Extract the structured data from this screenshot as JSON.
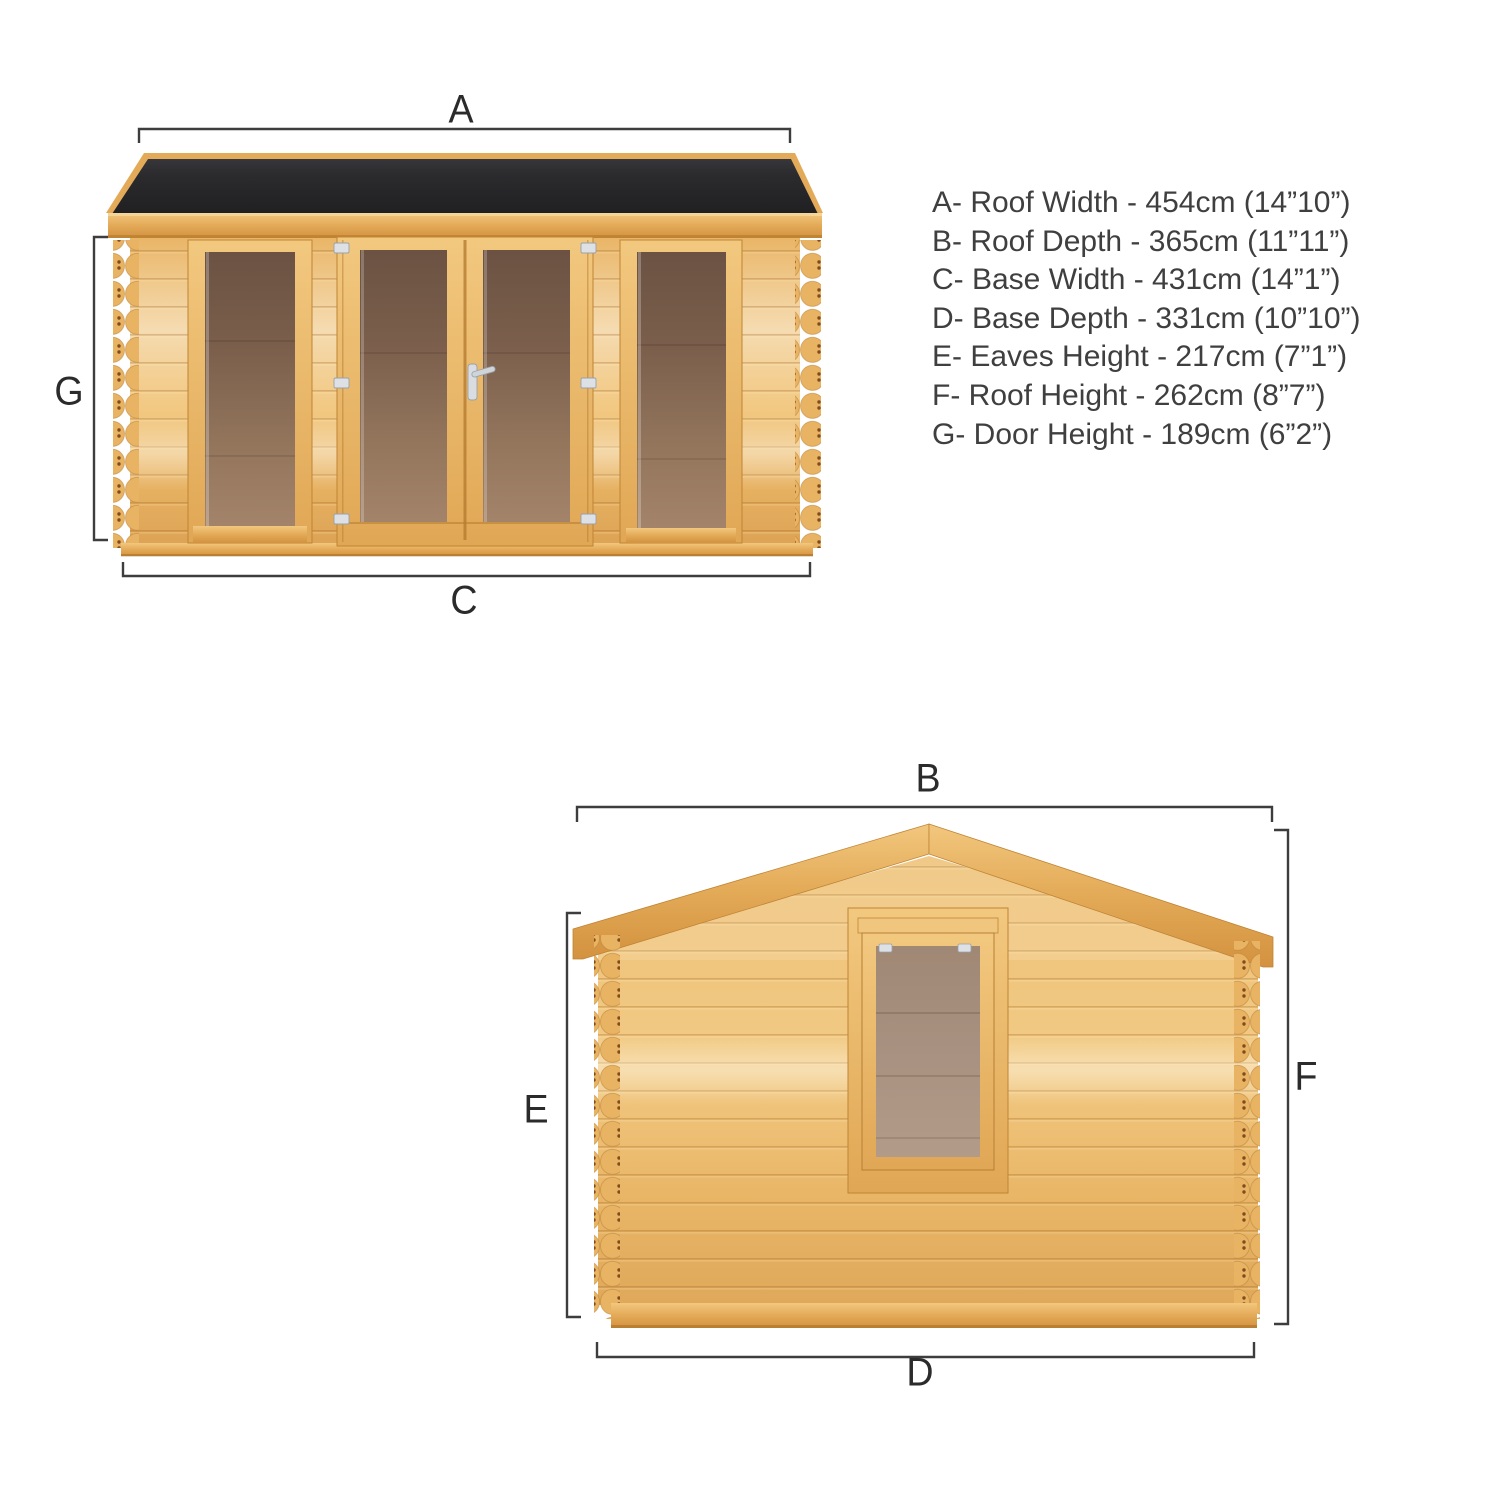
{
  "title": "Log cabin dimension diagram",
  "views": {
    "front": {
      "name": "front-elevation"
    },
    "side": {
      "name": "side-elevation"
    }
  },
  "dimension_labels": {
    "roof_width": "A",
    "roof_depth": "B",
    "base_width": "C",
    "base_depth": "D",
    "eaves_height": "E",
    "roof_height": "F",
    "door_height": "G"
  },
  "spec_list": {
    "items": [
      {
        "letter": "A",
        "name": "Roof Width",
        "metric": "454cm",
        "imperial": "14”10”",
        "text": "A- Roof Width - 454cm (14”10”)"
      },
      {
        "letter": "B",
        "name": "Roof Depth",
        "metric": "365cm",
        "imperial": "11”11”",
        "text": "B- Roof Depth - 365cm (11”11”)"
      },
      {
        "letter": "C",
        "name": "Base Width",
        "metric": "431cm",
        "imperial": "14”1”",
        "text": "C- Base Width - 431cm (14”1”)"
      },
      {
        "letter": "D",
        "name": "Base Depth",
        "metric": "331cm",
        "imperial": "10”10”",
        "text": "D- Base Depth - 331cm (10”10”)"
      },
      {
        "letter": "E",
        "name": "Eaves Height",
        "metric": "217cm",
        "imperial": "7”1”",
        "text": "E- Eaves Height - 217cm (7”1”)"
      },
      {
        "letter": "F",
        "name": "Roof Height",
        "metric": "262cm",
        "imperial": "8”7”",
        "text": "F- Roof Height - 262cm (8”7”)"
      },
      {
        "letter": "G",
        "name": "Door Height",
        "metric": "189cm",
        "imperial": "6”2”",
        "text": "G- Door Height - 189cm (6”2”)"
      }
    ]
  },
  "colors": {
    "background": "#ffffff",
    "roof_felt": "#29292b",
    "timber_light": "#f2c983",
    "timber_mid": "#e9b767",
    "timber_dark": "#d89f50",
    "glass_front": "#8e7058",
    "glass_side": "#a78f7c",
    "hardware_silver": "#d9dde1",
    "dimension_line": "#3d3d3d",
    "text": "#3f3f3f"
  }
}
